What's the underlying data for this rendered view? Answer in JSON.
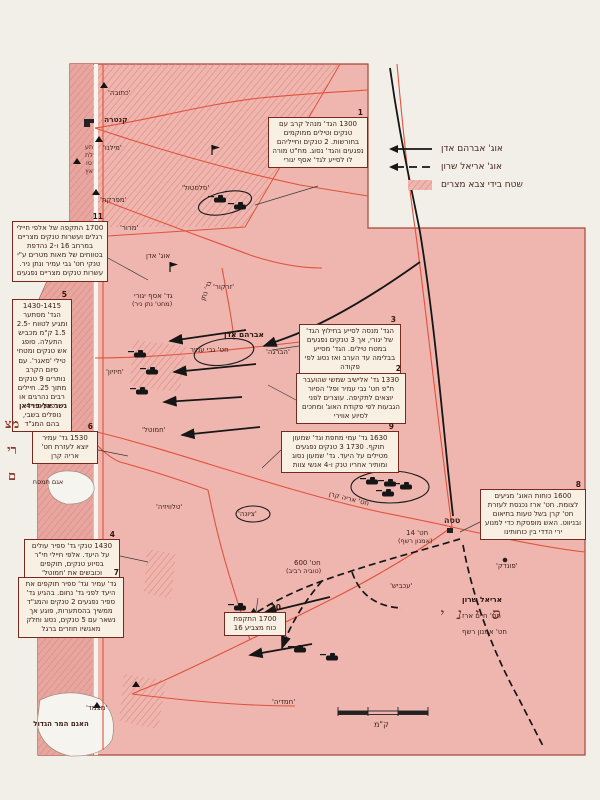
{
  "legend": {
    "items": [
      {
        "label": "אוג' אברהם אדן",
        "symbol": "solid-arrow"
      },
      {
        "label": "אוג' אריאל שרון",
        "symbol": "dashed-arrow"
      },
      {
        "label": "שטח בידי צבא מצרים",
        "symbol": "hatched-area"
      }
    ]
  },
  "boxes": [
    {
      "num": "1",
      "text": "1300 הגד' מנהל קרב עם טנקים וטילים ממוקמים בחורשות. 2 טנקים וחייליהם נפגעים והגד' נסוג. מח\"ט מורה לו לסייע לגד' אסף יגורי"
    },
    {
      "num": "11",
      "text": "1700 התקפה של אלפי חיילי רגלים ועשרות טנקים מצריים במרחב 16 ו-2 נהדפת בטווחים של מאות מטרים ע\"י טנקי חט' גבי עמיר ונתן ניר. עשרות טנקים מצריים נפגעים"
    },
    {
      "num": "5",
      "text": "1430-1415 הגד' מסתער ומגיע לטווח 2.5-1.5 ק\"מ מכביש התעלה. סופג אש טנקים ומטחי טילי 'סאגר'. עם סיום הקרב נותרים 9 טנקים מתוך 25. חיילים רבים נהרגים או נפגעים ו-4 נופלים בשבי, בהם המג\"ד"
    },
    {
      "num": "6",
      "text": "1530 גד' עמיר יוצא לעזרת חט' אריה קרן"
    },
    {
      "num": "4",
      "text": "1430 טנקי גד' ספיר עולים על היעד. אלפי חיילי חי\"ר בסיוע טנקים, תוקפים וכובשים את 'חמוטל'"
    },
    {
      "num": "7",
      "text": "גד' עמיר וגד' ספיר תוקפים את היעד לפני גד' נחום. בהגיע גד' ספיר נפגעים 2 טנקים והמג\"ד ממשיך בהסתערות, פוגע אך נשאר עם 5 טנקים, נסוג וחלק מאנשיו חוזרים ברגל"
    },
    {
      "num": "10",
      "text": "1700 התקפת כוח מצביע 16"
    },
    {
      "num": "3",
      "text": "הגד' מנסה לסייע בחילוץ הגד' של יגורי, אך 3 טנקים נפגעים במטח טילים. הגד' מסייע בבלימה עד הערב ואז נסוג לפי פקודה"
    },
    {
      "num": "2",
      "text": "1330 גד' אלישיב שמשי שהועבר ת\"פ חט' גבי עמיר ופל' הסיור יוצאים לתקיפה. עוצרים לפני הגבעות לפי פקודת האוג' ומחכים לסיוע אווירי"
    },
    {
      "num": "9",
      "text": "1630 גד' עמי מחפת וגד' שמעון תוקף. 1730 3 טנקים נפגעים מטילים על היעד. גד' שמעון נסוג ומותיר אחריו טנק ו-4 אנשי צוות"
    },
    {
      "num": "8",
      "text": "1600 כוחות האוג' מגיעים לצומת. חט' ארז נכנסת לעזרת חט' קרן בשל טעות בתיאום ובניווט. האש מופסקת כדי למנוע ירי הדדי בין כוחותינו"
    }
  ],
  "places": {
    "ketuba": "'כתובה'",
    "kantara": "קנטרה",
    "milano": "'מילנו'",
    "mifreket": "'מפרקת'",
    "salstul": "'סלסטול'",
    "maror": "'מרור'",
    "zarkor": "'זרקור'",
    "havraga": "'הברגה'",
    "hizayon": "'חיזיון'",
    "hamutal": "'חמוטל'",
    "televizia": "'טלוויזיה'",
    "tziona": "'ציונה'",
    "tasa": "טסה",
    "pundak": "'פונדק'",
    "akavish": "'עכביש'",
    "hamadia": "'חמדיה'",
    "matzmed": "'מצמד'",
    "firdan": "גשר אל-פרדאן",
    "timsah": "אגם תמסח",
    "bitter_lake": "האגם המר הגדול",
    "suez": "תעלת סואץ",
    "egypt": "מצרים",
    "sinai": "סיני"
  },
  "units": {
    "ugda_adan": "אוג' אדן",
    "yaguri": "גד' אסף יגורי",
    "yaguri2": "(מחט' נתן ניר)",
    "natan": "גד' נתן",
    "adan_route": "אברהם אדן",
    "gabi_amir": "חט' גבי עמיר",
    "keren": "חט' אריה קרן",
    "hat14": "חט' 14",
    "reshef14": "(אמנון רשף)",
    "hat600": "חט' 600",
    "raviv600": "(טוביה רביב)",
    "sharon": "אריאל שרון",
    "erez": "חט' חיים ארז",
    "reshef": "חט' אמנון רשף"
  },
  "scale": {
    "label": "ק\"מ"
  },
  "colors": {
    "map_pink": "#efb6b0",
    "west_bank_pink": "#e7a69f",
    "hatch_stripe": "#dd8d84",
    "road_red": "#e0523c",
    "border_red": "#a8473a",
    "box_bg": "#f8f0e2",
    "box_border": "#77291f",
    "military_black": "#161616"
  }
}
